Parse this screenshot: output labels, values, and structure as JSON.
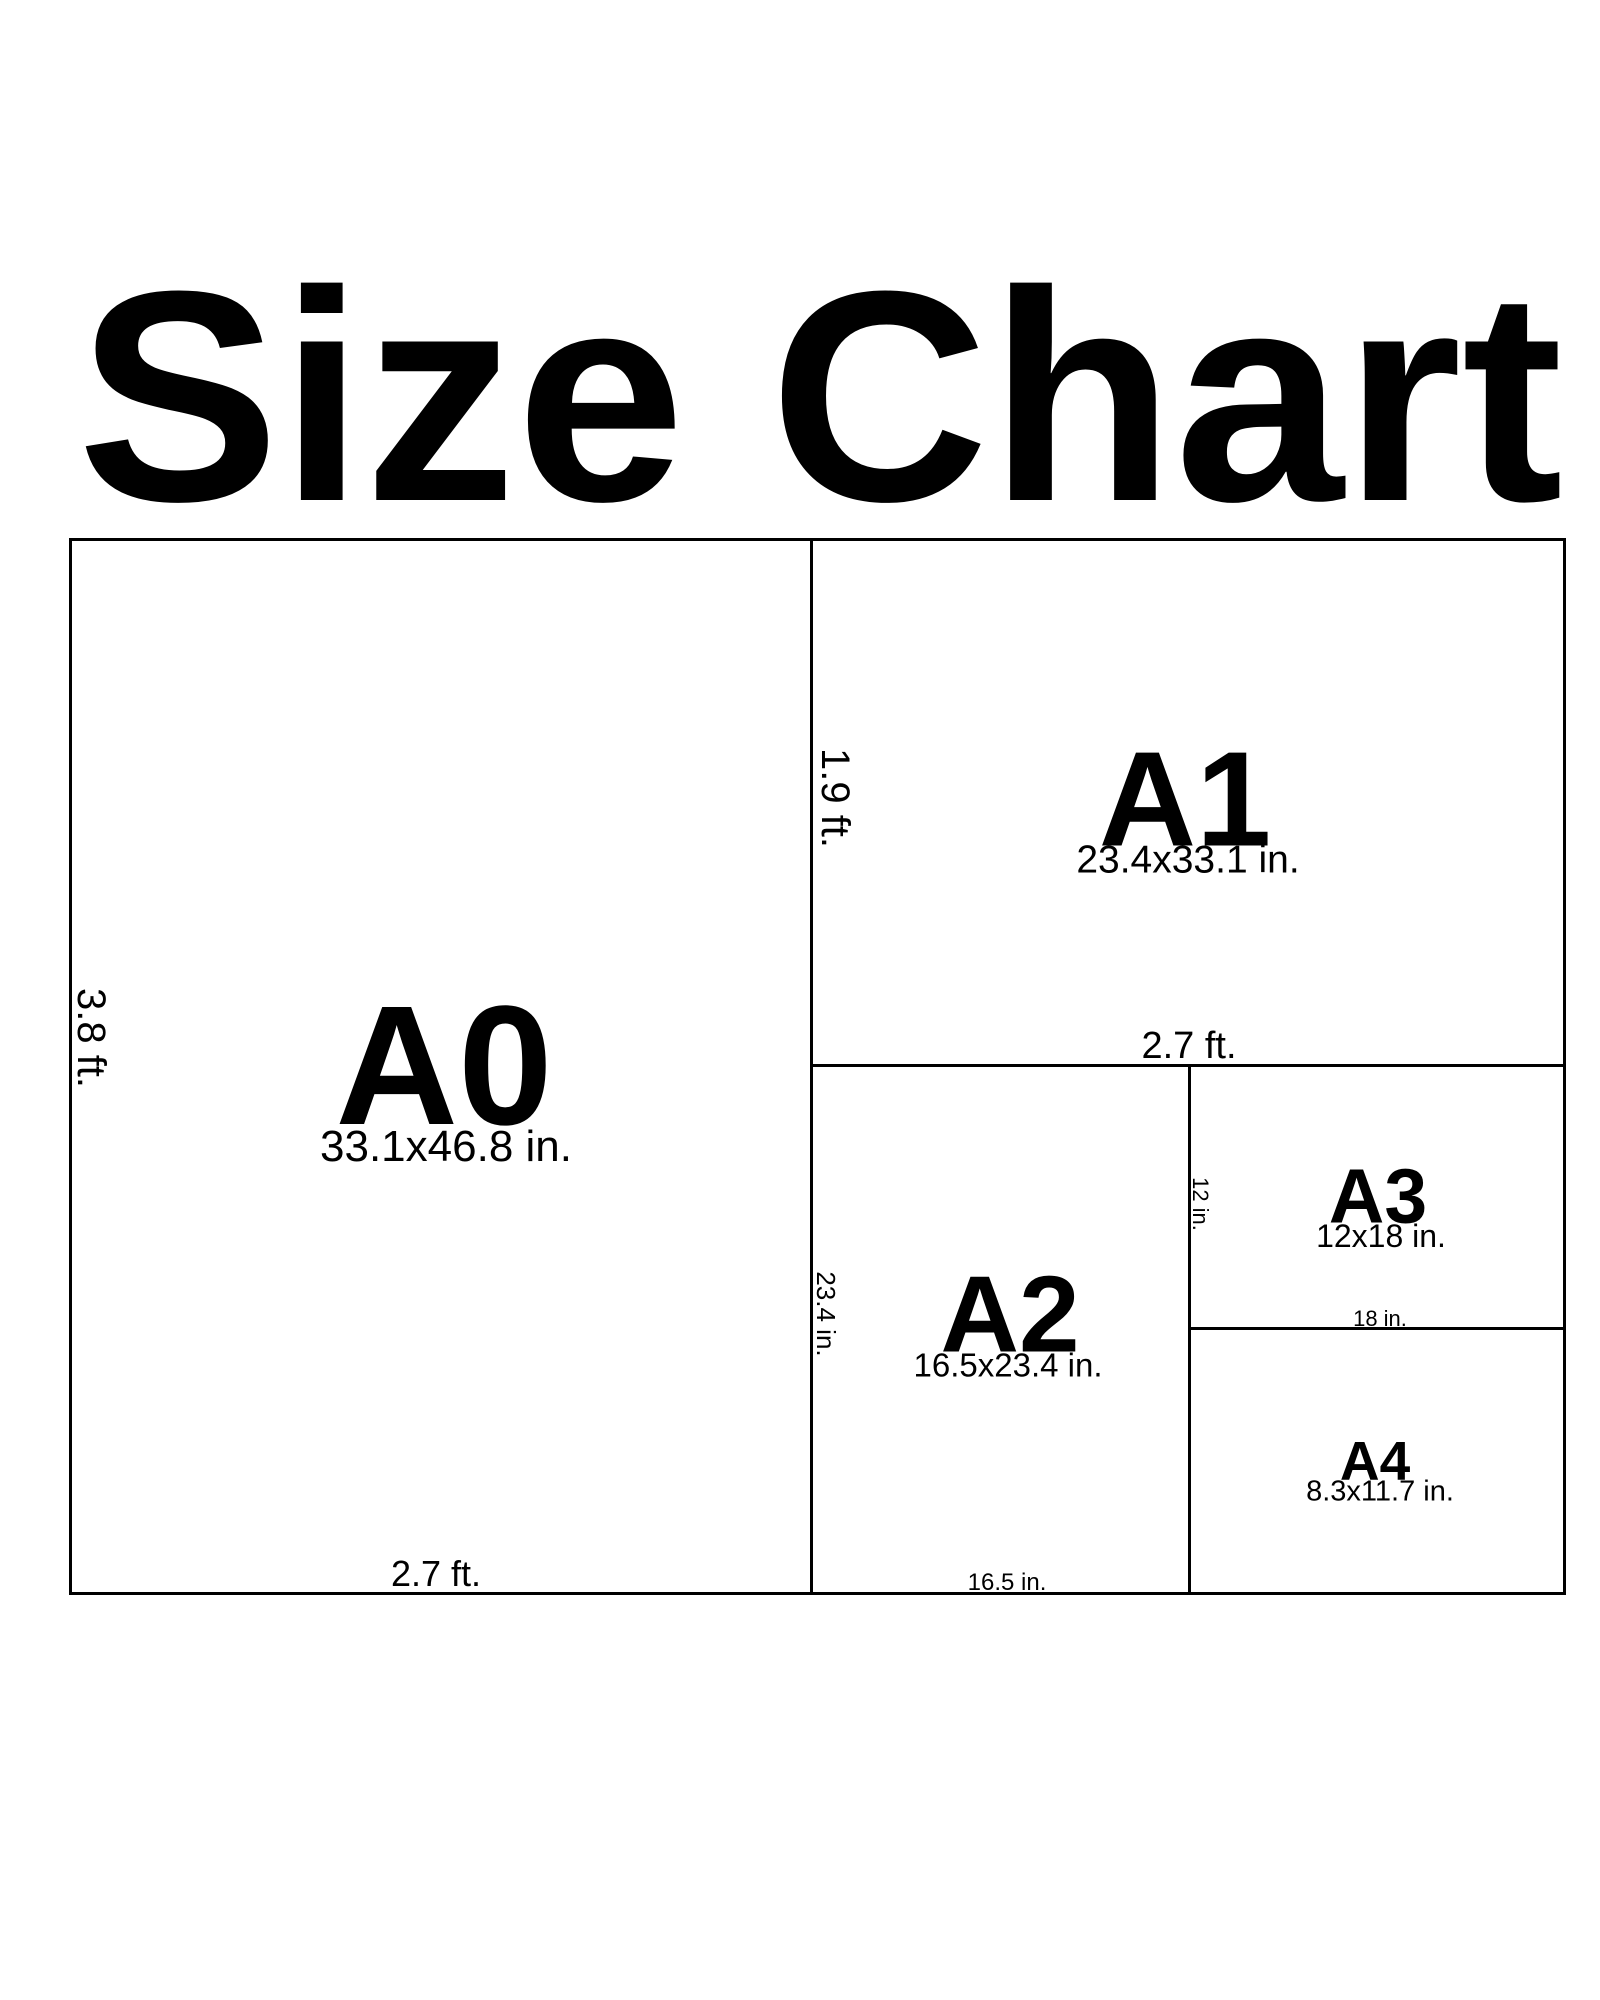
{
  "title": "Size Chart",
  "colors": {
    "ink": "#000000",
    "paper": "#ffffff"
  },
  "panels": {
    "a0": {
      "code": "A0",
      "dims": "33.1x46.8 in.",
      "side": "3.8 ft.",
      "bottom": "2.7 ft."
    },
    "a1": {
      "code": "A1",
      "dims": "23.4x33.1 in.",
      "side": "1.9 ft.",
      "bottom": "2.7 ft."
    },
    "a2": {
      "code": "A2",
      "dims": "16.5x23.4 in.",
      "side": "23.4 in.",
      "bottom": "16.5 in."
    },
    "a3": {
      "code": "A3",
      "dims": "12x18 in.",
      "side": "12 in.",
      "bottom": "18 in."
    },
    "a4": {
      "code": "A4",
      "dims": "8.3x11.7 in."
    }
  }
}
